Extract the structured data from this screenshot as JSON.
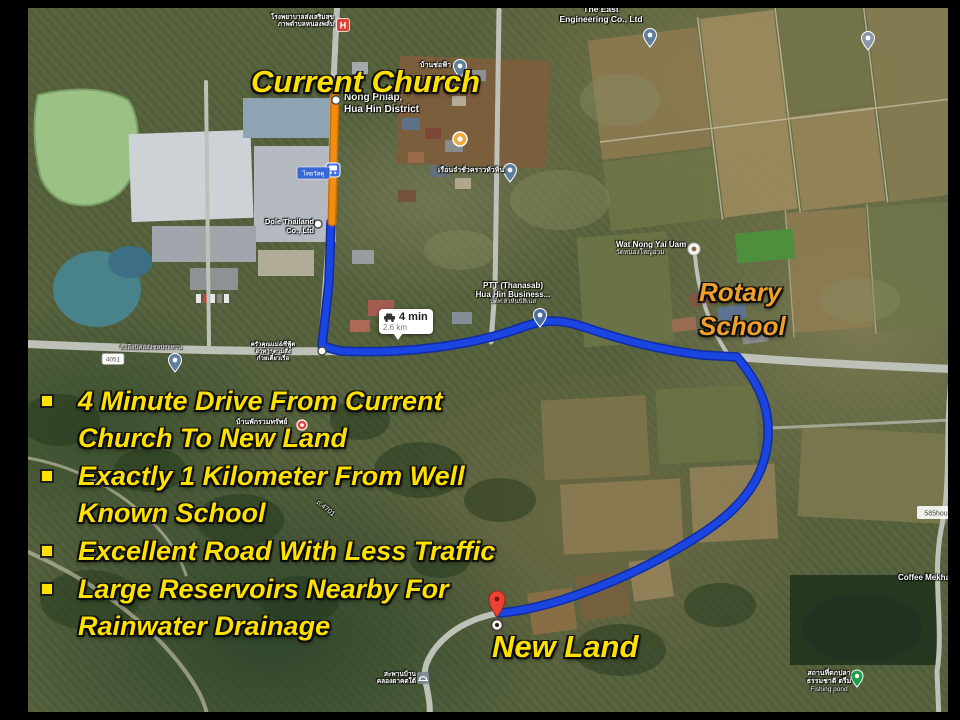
{
  "slide": {
    "labels": {
      "current_church": "Current Church",
      "rotary_line1": "Rotary",
      "rotary_line2": "School",
      "new_land": "New Land"
    },
    "bullets": [
      {
        "lines": [
          "4 Minute Drive From Current",
          "Church To New Land"
        ]
      },
      {
        "lines": [
          "Exactly 1 Kilometer From Well",
          "Known School"
        ]
      },
      {
        "lines": [
          "Excellent Road With Less Traffic"
        ]
      },
      {
        "lines": [
          "Large Reservoirs Nearby For",
          "Rainwater Drainage"
        ]
      }
    ]
  },
  "route_info": {
    "duration": "4 min",
    "distance": "2.6 km"
  },
  "map": {
    "labels": {
      "nong_phlap_1": "Nong Phlap,",
      "nong_phlap_2": "Hua Hin District",
      "hospital_1": "โรงพยาบาลส่งเสริมสุข",
      "hospital_2": "ภาพตำบลหนองพลับ",
      "east_eng_1": "The East",
      "east_eng_2": "Engineering Co., Ltd",
      "ban_cho": "บ้านช่อฟ้า",
      "prison": "เรือนจำชั่วคราวหัวหิน",
      "dole_1": "Dole Thailand",
      "dole_2": "Co., Ltd",
      "wat_1": "Wat Nong Yai Uam",
      "wat_2": "วัดหนองใหญ่อวม",
      "ptt_1": "PTT (Thanasab)",
      "ptt_2": "Hua Hin Business...",
      "ptt_3": "ปตท.หัวหินบิสิเนส",
      "road_name": "ถ.เลียบคลองชลประทาน",
      "krua_1": "ครัวคุณแม่&ซีฟู้ด",
      "krua_2": "อาหารตามสั่ง",
      "krua_3": "ก๋วยเตี๋ยวเรือ",
      "ban_phak": "บ้านพักรวมทรัพย์",
      "road_4701": "ถ.4701",
      "coffee": "Coffee Mekha",
      "fishing_1": "สถานที่ตกปลา",
      "fishing_2": "ธรรมชาติ ตรีม",
      "fishing_3": "Fishing pond",
      "bridge_1": "สะพานบ้าน",
      "bridge_2": "คลองตาคตใต้",
      "thaiwatsadu": "ไทยวัสดุ",
      "shield": "4051",
      "house585": "585hou"
    },
    "icons": {
      "hospital_glyph": "H"
    }
  },
  "colors": {
    "route_blue": "#1b45e0",
    "route_blue_edge": "#0e2ca6",
    "route_orange": "#f28d12",
    "route_orange_edge": "#c96f05",
    "annotation_yellow": "#ffe100",
    "annotation_orange": "#f0a028"
  }
}
